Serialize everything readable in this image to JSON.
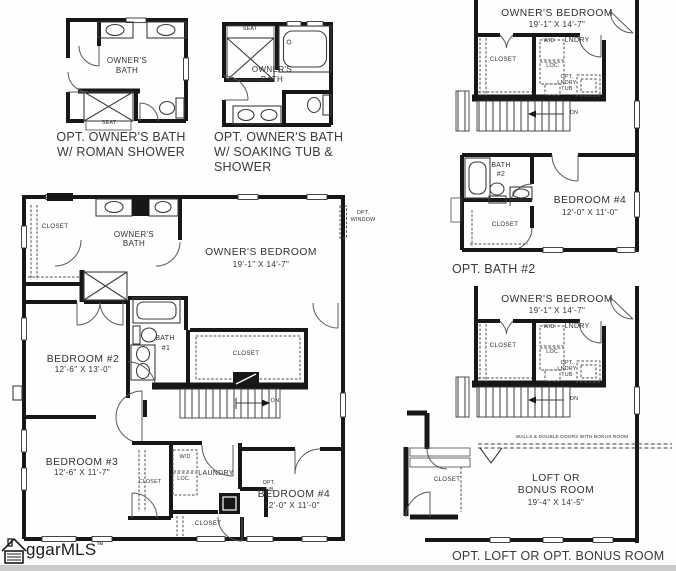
{
  "shared": {
    "closet": "CLOSET",
    "seat": "SEAT",
    "wd": "W/D",
    "lndry": "LNDRY",
    "loc": "LOC.",
    "laundry": "LAUNDRY",
    "dn": "DN",
    "opt": "OPT.",
    "tub": "TUB",
    "window": "WINDOW",
    "owners": "OWNER'S",
    "bath": "BATH",
    "owners_bedroom": "OWNER'S BEDROOM",
    "owners_bedroom_dims": "19'-1\" X 14'-7\"",
    "bedroom4": "BEDROOM #4",
    "bedroom4_dims": "12'-0\" X 11'-0\""
  },
  "plan_roman": {
    "caption_1": "OPT. OWNER'S BATH",
    "caption_2": "W/ ROMAN SHOWER"
  },
  "plan_soaking": {
    "caption_1": "OPT. OWNER'S BATH",
    "caption_2": "W/ SOAKING TUB &",
    "caption_3": "SHOWER"
  },
  "plan_bath2": {
    "caption": "OPT. BATH #2",
    "number": "#2"
  },
  "plan_loft": {
    "caption": "OPT. LOFT OR OPT. BONUS ROOM",
    "note": "WALLS & DOUBLE DOORS WITH BONUS ROOM",
    "line_1": "LOFT OR",
    "line_2": "BONUS ROOM",
    "dims": "19'-4\" X 14'-5\""
  },
  "plan_main": {
    "bedroom2": "BEDROOM #2",
    "bedroom2_dims": "12'-6\" X 13'-0\"",
    "bath1_number": "#1",
    "bedroom3": "BEDROOM #3",
    "bedroom3_dims": "12'-6\" X 11'-7\""
  },
  "logo": {
    "text": "ggarMLS",
    "tm": "™"
  }
}
